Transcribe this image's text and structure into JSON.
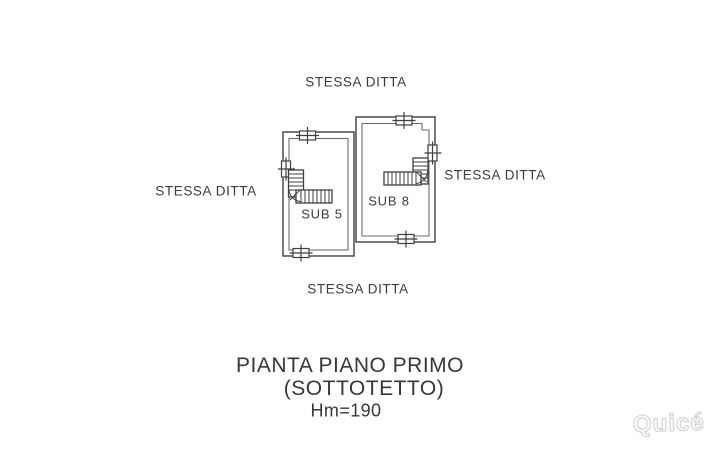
{
  "page": {
    "background": "#ffffff",
    "line_color": "#3f3f3f",
    "inner_line_color": "#6e6e6e",
    "text_color": "#3b3b3b"
  },
  "plan": {
    "neighbors": {
      "top": "STESSA DITTA",
      "left": "STESSA DITTA",
      "right": "STESSA DITTA",
      "bottom": "STESSA DITTA"
    },
    "rooms": [
      {
        "label": "SUB 5"
      },
      {
        "label": "SUB 8"
      }
    ]
  },
  "title": {
    "line1": "PIANTA PIANO PRIMO",
    "line2": "(SOTTOTETTO)",
    "line3": "Hm=190"
  },
  "watermark": {
    "text": "Quicé"
  }
}
